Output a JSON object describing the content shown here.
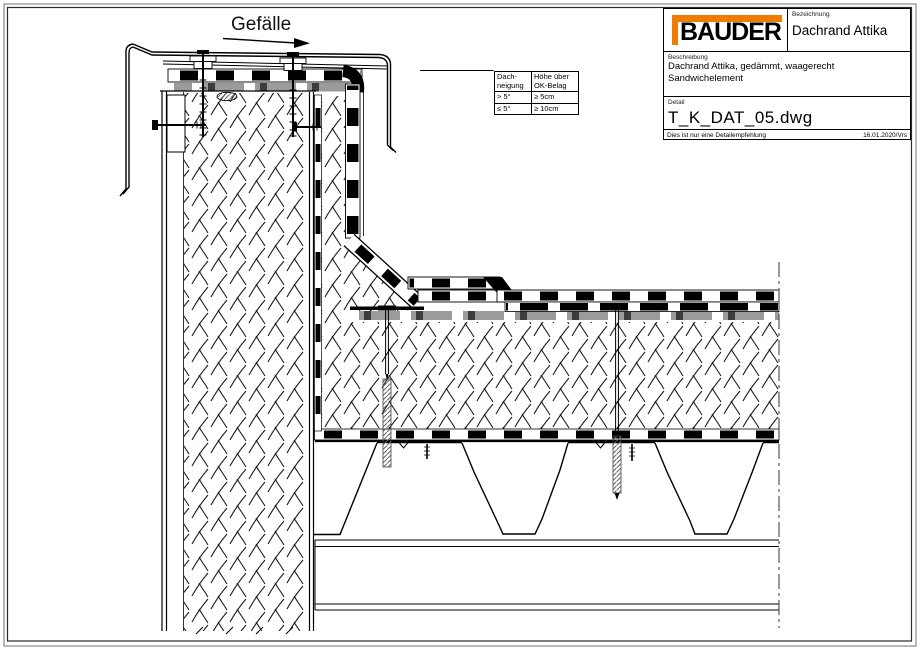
{
  "drawing": {
    "gefaelle_label": "Gefälle",
    "slope_table": {
      "col1_header": "Dach-\nneigung",
      "col2_header": "Höhe über\nOK-Belag",
      "rows": [
        {
          "neigung": "> 5°",
          "hoehe": "≥ 5cm"
        },
        {
          "neigung": "≤ 5°",
          "hoehe": "≥ 10cm"
        }
      ]
    }
  },
  "title_block": {
    "logo_text": "BAUDER",
    "bezeichnung_label": "Bezeichnung",
    "bezeichnung_value": "Dachrand Attika",
    "beschreibung_label": "Beschreibung",
    "beschreibung_line1": "Dachrand Attika, gedämmt, waagerecht",
    "beschreibung_line2": "Sandwichelement",
    "detail_label": "Detail",
    "detail_value": "T_K_DAT_05.dwg",
    "footer_note": "Dies ist nur eine Detailempfehlung",
    "footer_date": "16.01.2020/Vrs"
  },
  "colors": {
    "logo_orange": "#EE7C00",
    "membrane_black": "#000000",
    "separation_gray": "#9b9b9b",
    "line_black": "#1a1a1a"
  }
}
